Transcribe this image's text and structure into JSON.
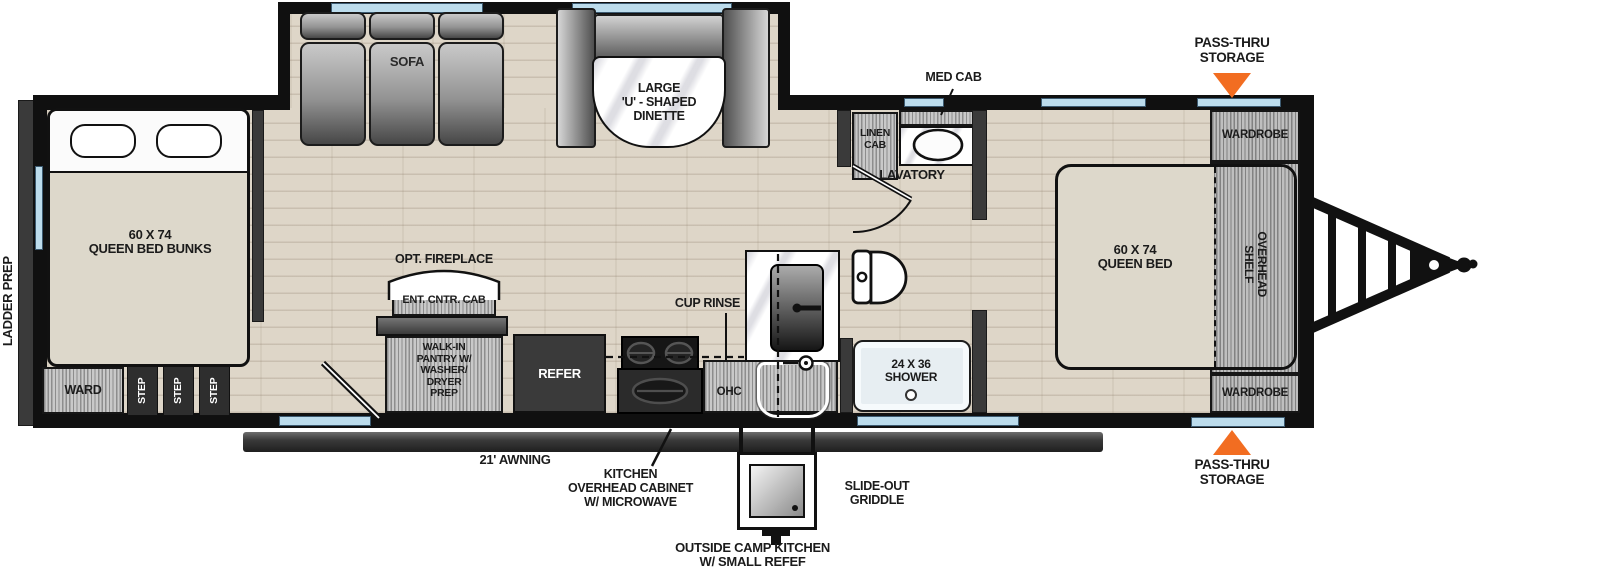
{
  "diagram": {
    "type": "rv-travel-trailer-floorplan"
  },
  "areas": {
    "rear_bunk_room": {
      "ladder_prep": "LADDER PREP",
      "bed": "60 X 74\nQUEEN BED BUNKS",
      "ward": "WARD",
      "step": "STEP"
    },
    "living": {
      "sofa": "SOFA",
      "dinette": "LARGE\n'U' - SHAPED\nDINETTE",
      "opt_fireplace": "OPT. FIREPLACE",
      "ent_cntr_cab": "ENT. CNTR. CAB",
      "pantry": "WALK-IN\nPANTRY W/\nWASHER/\nDRYER\nPREP",
      "refer": "REFER"
    },
    "kitchen": {
      "cup_rinse": "CUP RINSE",
      "ohc": "OHC",
      "overhead_cabinet_note": "KITCHEN\nOVERHEAD CABINET\nW/ MICROWAVE"
    },
    "bath": {
      "linen_cab": "LINEN\nCAB",
      "med_cab": "MED CAB",
      "lavatory": "LAVATORY",
      "shower": "24 X 36\nSHOWER"
    },
    "front_bedroom": {
      "bed": "60 X 74\nQUEEN BED",
      "overhead_shelf": "OVERHEAD\nSHELF",
      "wardrobe": "WARDROBE"
    },
    "exterior": {
      "pass_thru": "PASS-THRU\nSTORAGE",
      "awning": "21' AWNING",
      "slide_out_griddle": "SLIDE-OUT\nGRIDDLE",
      "outside_kitchen": "OUTSIDE CAMP KITCHEN\nW/ SMALL REFEF"
    }
  },
  "colors": {
    "accent_orange": "#F26D21",
    "window_blue": "#BCDCEC",
    "wall_black": "#101010",
    "floor_wood": "#DED6C8"
  }
}
